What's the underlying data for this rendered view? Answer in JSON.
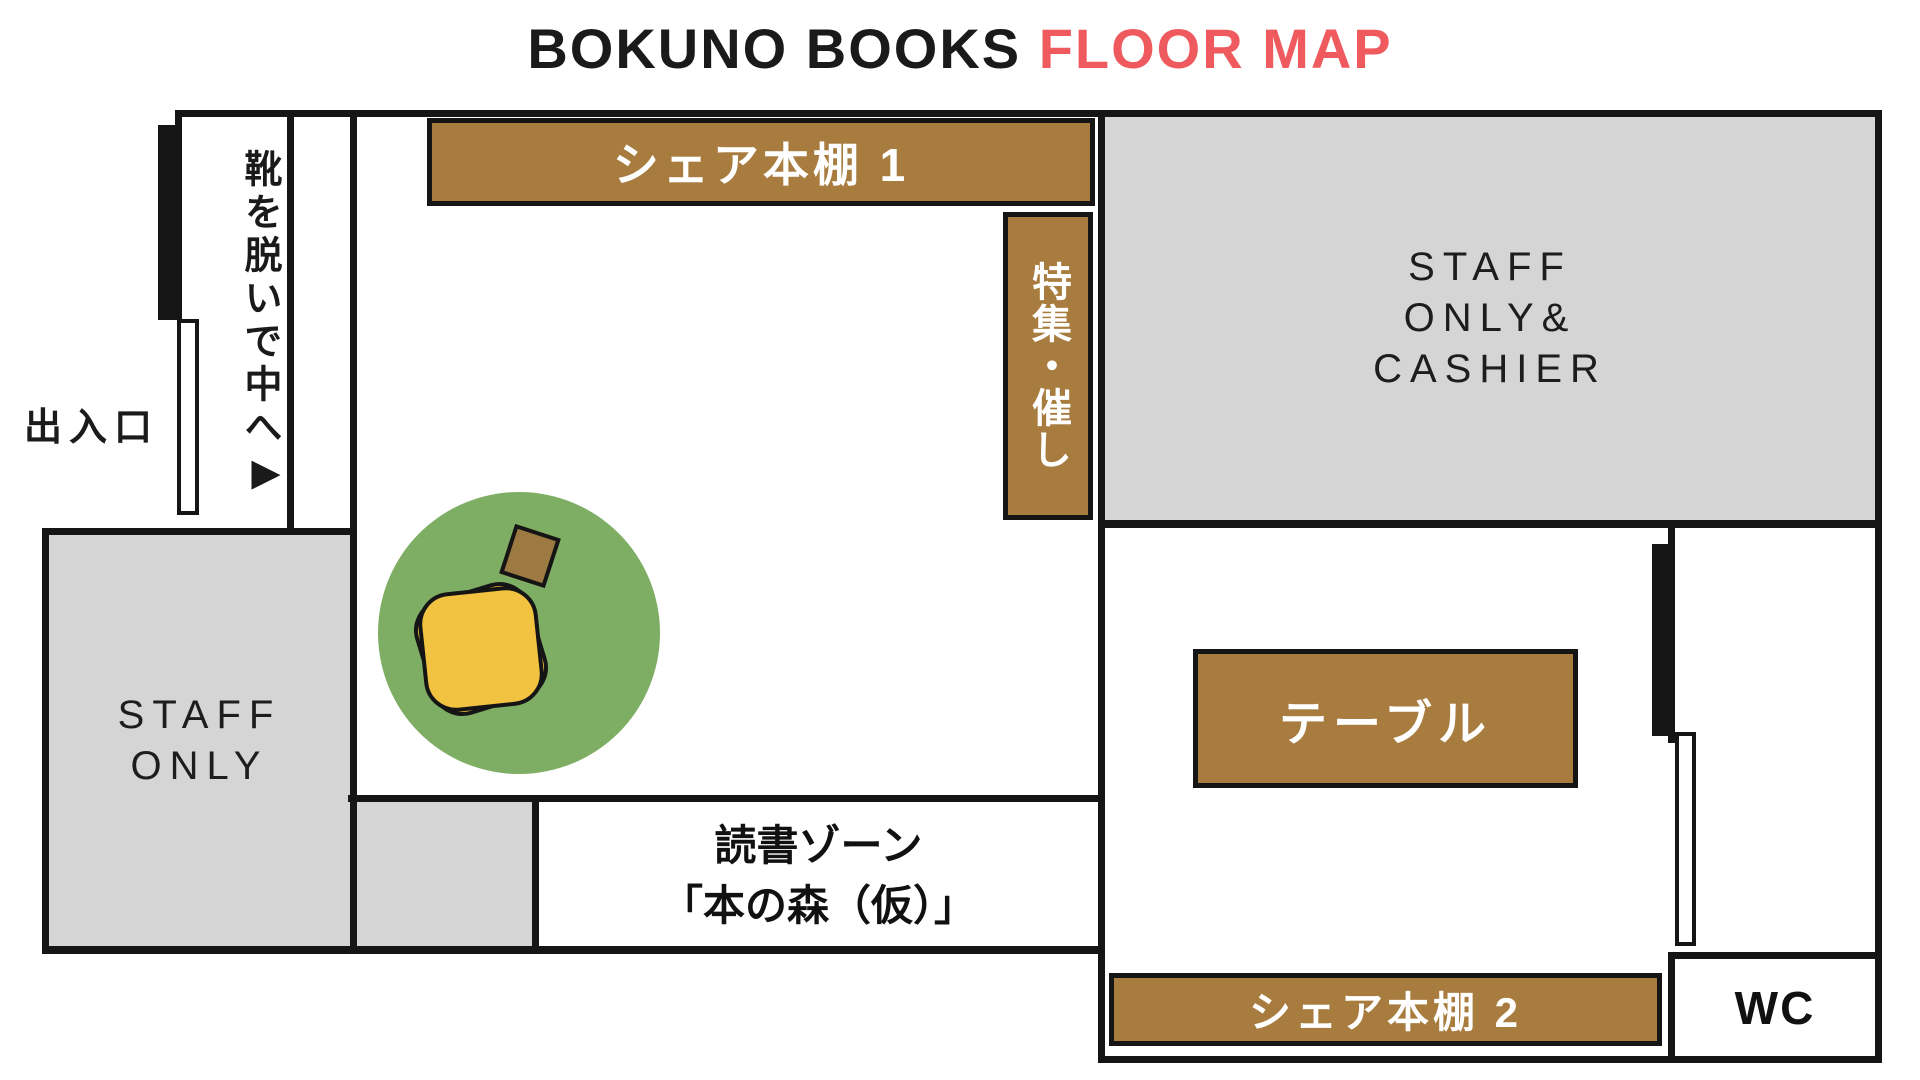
{
  "title": {
    "prefix": "BOKUNO BOOKS ",
    "highlight": "FLOOR MAP"
  },
  "colors": {
    "accent_red": "#EF5A5F",
    "shelf_brown": "#A87C3E",
    "area_gray": "#D5D5D5",
    "grass_green": "#7DAE63",
    "table_yellow": "#F2C340",
    "wood_brown": "#9C7A41",
    "wall_black": "#151515"
  },
  "areas": {
    "entrance_label": "出入口",
    "shoes_note": "靴を脱いで中へ",
    "shoes_arrow": "▶",
    "shelf1_label": "シェア本棚 1",
    "feature_label": "特集・催し",
    "cashier_lines": [
      "STAFF",
      "ONLY&",
      "CASHIER"
    ],
    "staff_lines": [
      "STAFF",
      "ONLY"
    ],
    "reading_lines": [
      "読書ゾーン",
      "「本の森（仮）」"
    ],
    "table_label": "テーブル",
    "shelf2_label": "シェア本棚 2",
    "wc_label": "WC"
  }
}
